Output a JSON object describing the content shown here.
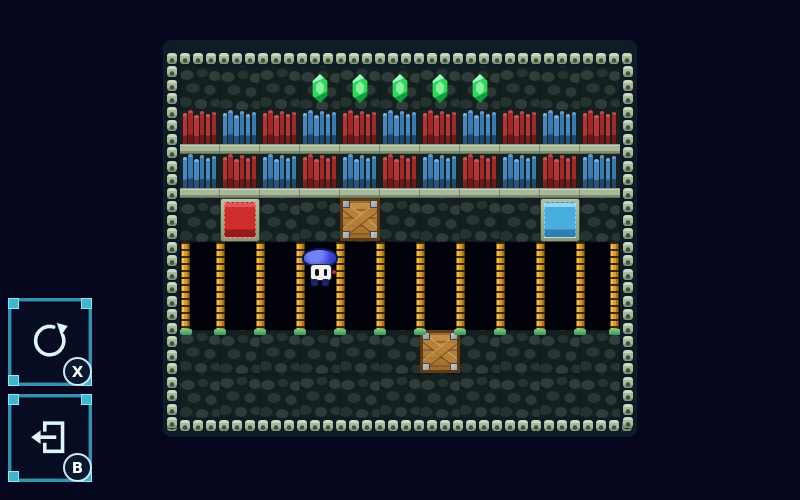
{
  "screen": {
    "background": "#06061f"
  },
  "hud": {
    "buttons": [
      {
        "action": "restart",
        "icon": "restart-icon",
        "key_label": "X"
      },
      {
        "action": "exit-level",
        "icon": "exit-icon",
        "key_label": "B"
      }
    ]
  },
  "board": {
    "cols": 11,
    "rows": 8,
    "tile_width": 40,
    "tile_height": 44,
    "terrain_rows": [
      "stone",
      "shelf-a",
      "shelf-b",
      "stone",
      "ladder",
      "ladder",
      "stone",
      "stone"
    ],
    "shelf_patterns": {
      "shelf-a": [
        "red",
        "blue"
      ],
      "shelf-b": [
        "blue",
        "red"
      ]
    },
    "gems": [
      {
        "row": 0,
        "col": 3
      },
      {
        "row": 0,
        "col": 4
      },
      {
        "row": 0,
        "col": 5
      },
      {
        "row": 0,
        "col": 6
      },
      {
        "row": 0,
        "col": 7
      }
    ],
    "entities": [
      {
        "type": "red-block",
        "row": 3,
        "col": 1
      },
      {
        "type": "crate",
        "row": 3,
        "col": 4
      },
      {
        "type": "blue-block",
        "row": 3,
        "col": 9
      },
      {
        "type": "crate",
        "row": 6,
        "col": 6
      }
    ],
    "ladders": {
      "rows": [
        4,
        5
      ],
      "at_column_boundaries": true,
      "count": 12
    },
    "player": {
      "row": 4,
      "col": 3,
      "sprite": "blue-mushroom-character"
    }
  },
  "colors": {
    "background": "#06061f",
    "board_band": "#0e1c27",
    "stone": "#2e3d3a",
    "border_tile": "#a9b79b",
    "book_red": "#bb3232",
    "book_blue": "#4488c4",
    "red_block": "#cf2d2d",
    "blue_block": "#49ade0",
    "crate_wood": "#b5803a",
    "ladder_gold": "#d89c28",
    "gem_green": "#2ed958",
    "player_cap_blue": "#3e4fd8",
    "hud_border_cyan": "#2f93ac",
    "hud_corner_cyan": "#3fb6cf"
  }
}
